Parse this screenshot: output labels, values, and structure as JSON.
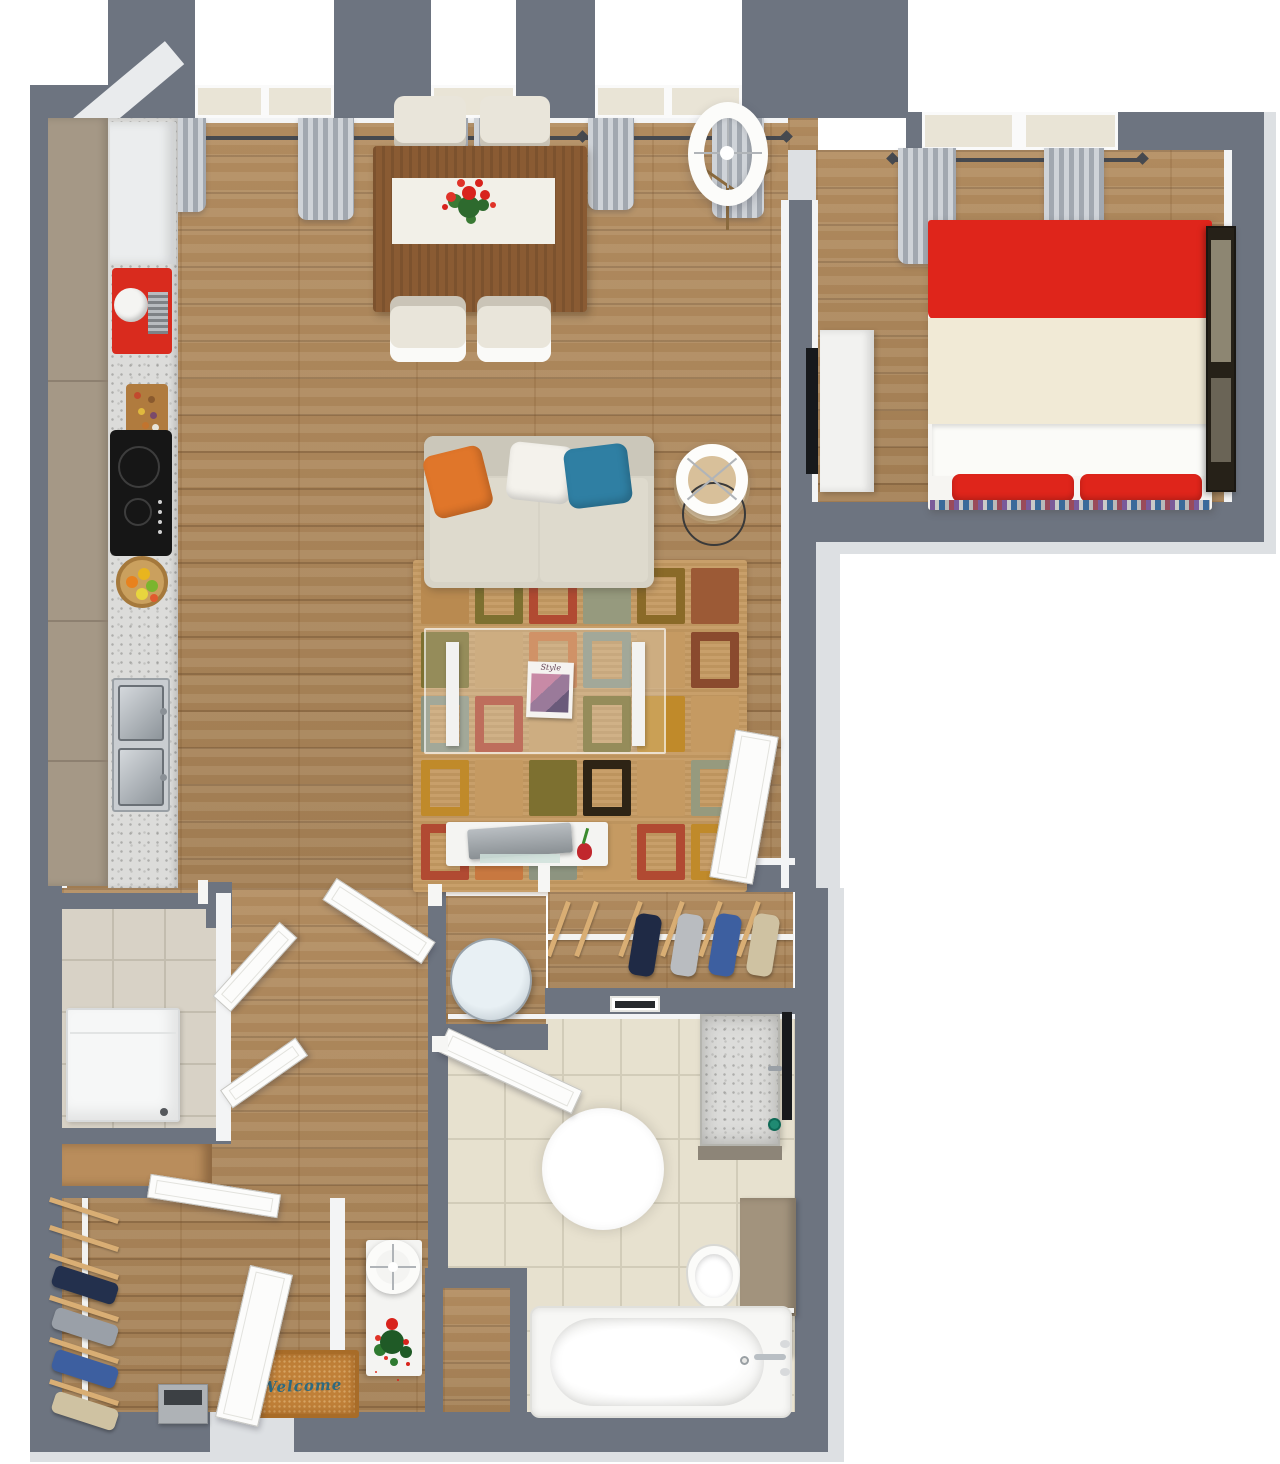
{
  "texts": {
    "doormat": "Welcome",
    "magazine_title": "Style"
  },
  "palette": {
    "wall": "#6d7480",
    "wall_light": "#dde0e3",
    "wall_face": "#f3f4f5",
    "wood": "#a8835a",
    "tile_bath": "#e7e1cf",
    "tile_grout": "#d2ccb9",
    "tile_laundry": "#d8d2c6",
    "granite": "#dcdcda",
    "rug_base": "#c59a62",
    "sofa": "#d7d3c6",
    "pillow_orange": "#e0762a",
    "pillow_blue": "#2f7fa3",
    "bed_red": "#df251b",
    "bed_cream": "#f1ead6",
    "cabinet_taupe": "#a59886",
    "appliance_red": "#d92b1e",
    "curtain_gray": "#b8bcc4",
    "doormat": "#c08038",
    "doormat_text": "#2e6a80",
    "towel_dark": "#2b2e33",
    "soap_green": "#1f8a72",
    "table_wood": "#8a5b33",
    "bathroom_cabinet": "#a2937d"
  },
  "rug_cells": [
    {
      "c": "#b98a50",
      "s": "fill"
    },
    {
      "c": "#7d7030",
      "s": "frame"
    },
    {
      "c": "#b14a32",
      "s": "frame"
    },
    {
      "c": "#969a7e",
      "s": "fill"
    },
    {
      "c": "#8a6a28",
      "s": "frame"
    },
    {
      "c": "#9c5a36",
      "s": "fill"
    },
    {
      "c": "#7d7030",
      "s": "fill"
    },
    {
      "c": "#c59a62",
      "s": "fill"
    },
    {
      "c": "#c87840",
      "s": "frame"
    },
    {
      "c": "#8d9480",
      "s": "frame"
    },
    {
      "c": "#c59a62",
      "s": "fill"
    },
    {
      "c": "#8a4a2e",
      "s": "frame"
    },
    {
      "c": "#8d9480",
      "s": "frame"
    },
    {
      "c": "#b14a32",
      "s": "frame"
    },
    {
      "c": "#c59a62",
      "s": "fill"
    },
    {
      "c": "#7d7030",
      "s": "frame"
    },
    {
      "c": "#c08a2a",
      "s": "fill"
    },
    {
      "c": "#c59a62",
      "s": "fill"
    },
    {
      "c": "#c08a2a",
      "s": "frame"
    },
    {
      "c": "#c59a62",
      "s": "fill"
    },
    {
      "c": "#7d7030",
      "s": "fill"
    },
    {
      "c": "#2e2415",
      "s": "frame"
    },
    {
      "c": "#c59a62",
      "s": "fill"
    },
    {
      "c": "#969a7e",
      "s": "frame"
    },
    {
      "c": "#b14a32",
      "s": "frame"
    },
    {
      "c": "#c87840",
      "s": "fill"
    },
    {
      "c": "#8d9480",
      "s": "fill"
    },
    {
      "c": "#c59a62",
      "s": "fill"
    },
    {
      "c": "#b14a32",
      "s": "frame"
    },
    {
      "c": "#c08a2a",
      "s": "frame"
    }
  ],
  "hall_closet_hangers": [
    {
      "x": 8,
      "color": null
    },
    {
      "x": 36,
      "color": null
    },
    {
      "x": 80,
      "color": "#1f2a45"
    },
    {
      "x": 122,
      "color": "#b9bcc0"
    },
    {
      "x": 160,
      "color": "#3d5fa0"
    },
    {
      "x": 198,
      "color": "#cfc2a2"
    }
  ],
  "wardrobe_hangers": [
    {
      "y": 10,
      "color": null
    },
    {
      "y": 38,
      "color": null
    },
    {
      "y": 66,
      "color": "#23304d"
    },
    {
      "y": 108,
      "color": "#9aa0a8"
    },
    {
      "y": 150,
      "color": "#3d5fa0"
    },
    {
      "y": 192,
      "color": "#cfc2a2"
    }
  ]
}
